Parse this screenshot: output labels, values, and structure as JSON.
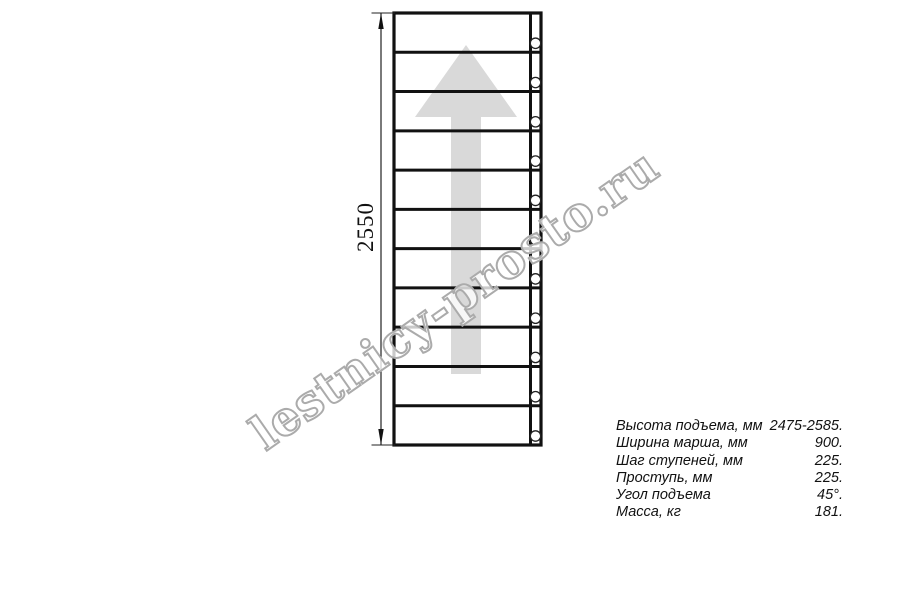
{
  "diagram": {
    "type": "staircase-plan-top-view",
    "dimension_label": "2550",
    "treads": 11,
    "stringer_holes": 11,
    "direction_arrow": "up",
    "colors": {
      "line": "#111111",
      "dimension_line": "#222222",
      "arrow_fill": "#d9d9d9",
      "watermark": "#ababab"
    }
  },
  "watermark": {
    "text": "lestnicy-prosto.ru"
  },
  "specs": {
    "rows": [
      {
        "label": "Высота подъема, мм",
        "value": "2475-2585."
      },
      {
        "label": "Ширина марша, мм",
        "value": "900."
      },
      {
        "label": "Шаг ступеней, мм",
        "value": "225."
      },
      {
        "label": "Проступь, мм",
        "value": "225."
      },
      {
        "label": "Угол подъема",
        "value": "45°."
      },
      {
        "label": "Масса, кг",
        "value": "181."
      }
    ]
  }
}
